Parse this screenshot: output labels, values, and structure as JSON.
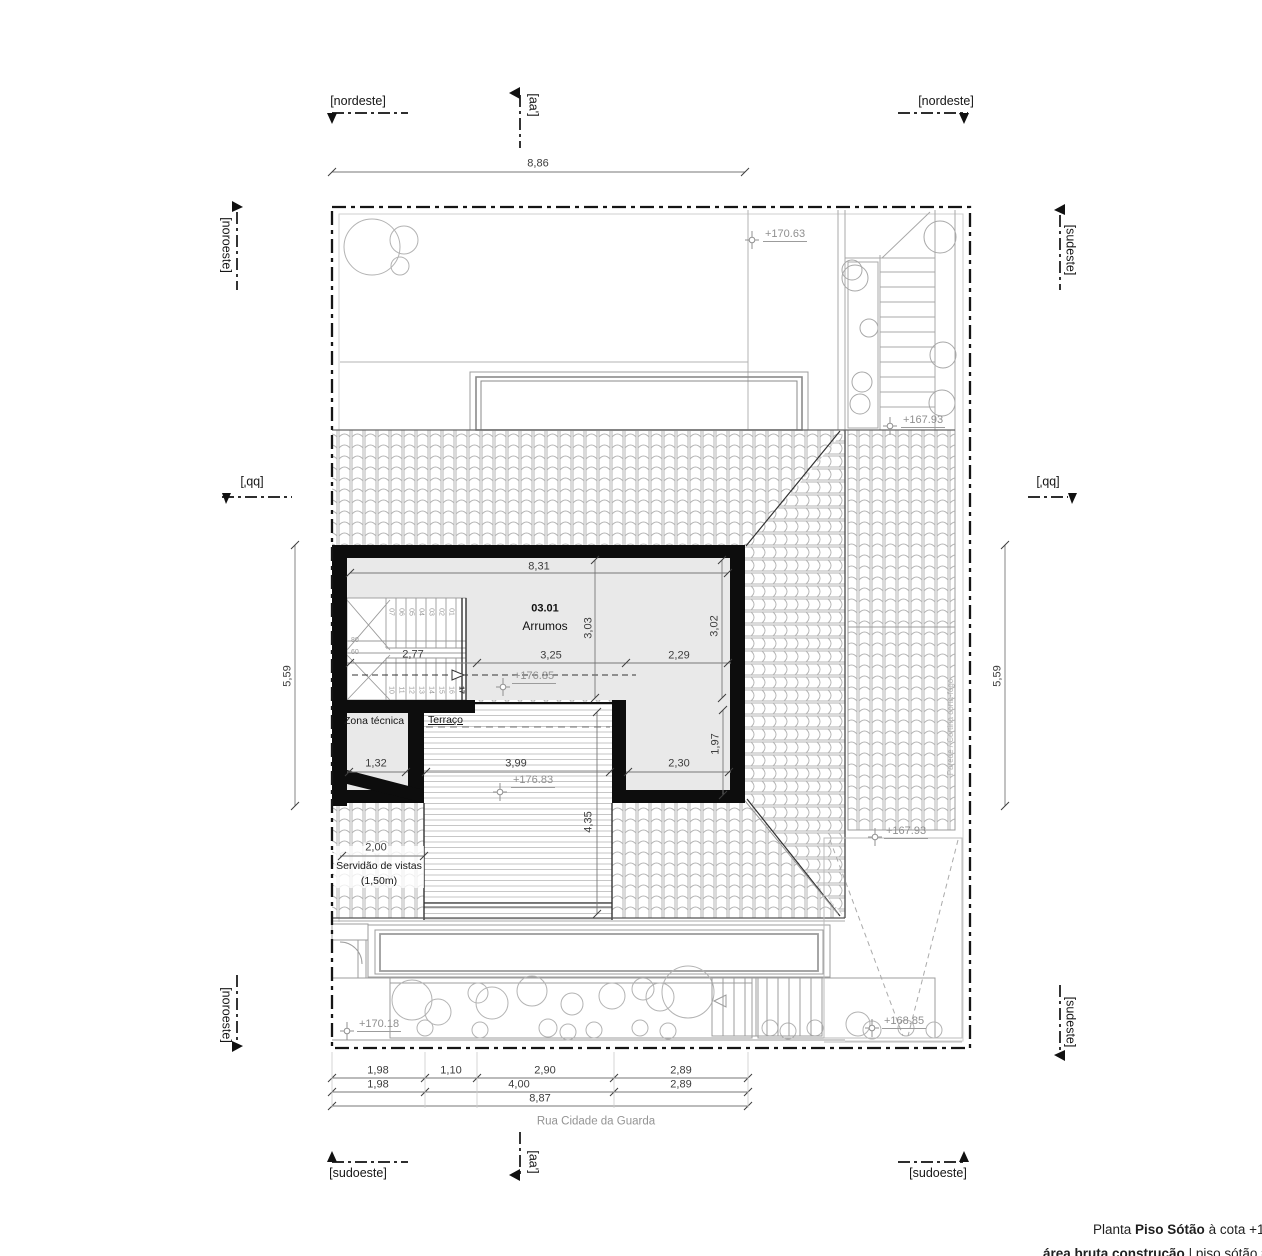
{
  "plan": {
    "markers": {
      "nordeste": "[nordeste]",
      "sudoeste": "[sudoeste]",
      "noroeste": "[noroeste]",
      "sudeste": "[sudeste]",
      "section_aa": "[aa']",
      "section_bb": "[bb']"
    },
    "room": {
      "number": "03.01",
      "name": "Arrumos"
    },
    "areas": {
      "zona_tecnica": "Zona técnica",
      "terraco": "Terraço",
      "servidao_1": "Servidão de vistas",
      "servidao_2": "(1,50m)",
      "parede_cortina": "Parede / Cortina corta-fogo"
    },
    "street": "Rua Cidade da Guarda",
    "elevations": {
      "garden_top": "+170.63",
      "stair_top": "+167.93",
      "room_floor": "+176.85",
      "terrace_floor": "+176.83",
      "roof_edge": "+167.93",
      "garden_bottom": "+170.18",
      "ramp_bottom": "+168.85"
    },
    "dims": {
      "top_width": "8,86",
      "left_height": "5,59",
      "right_height": "5,59",
      "room_width": "8,31",
      "room_depth_mid": "3,03",
      "room_depth_right": "3,02",
      "stair_width": "2,77",
      "room_mid_width": "3,25",
      "room_right_width": "2,29",
      "zona_width": "1,32",
      "terrace_width": "3,99",
      "terrace_depth": "4,35",
      "leg_width": "2,30",
      "leg_depth": "1,97",
      "servidao_width": "2,00",
      "bottom_row1": [
        "1,98",
        "1,10",
        "2,90",
        "2,89"
      ],
      "bottom_row2": [
        "1,98",
        "4,00",
        "2,89"
      ],
      "bottom_total": "8,87"
    },
    "stairs": {
      "upper": [
        "07",
        "06",
        "05",
        "04",
        "03",
        "02",
        "01"
      ],
      "lower": [
        "10",
        "11",
        "12",
        "13",
        "14",
        "15",
        "16",
        "17"
      ],
      "landing_width": "80",
      "landing_width2": "60"
    }
  },
  "title_block": {
    "prefix": "Planta",
    "name": "Piso Sótão",
    "suffix": "à cota +178",
    "area_label": "área bruta construção",
    "area_value": "| piso sótão = 03"
  }
}
